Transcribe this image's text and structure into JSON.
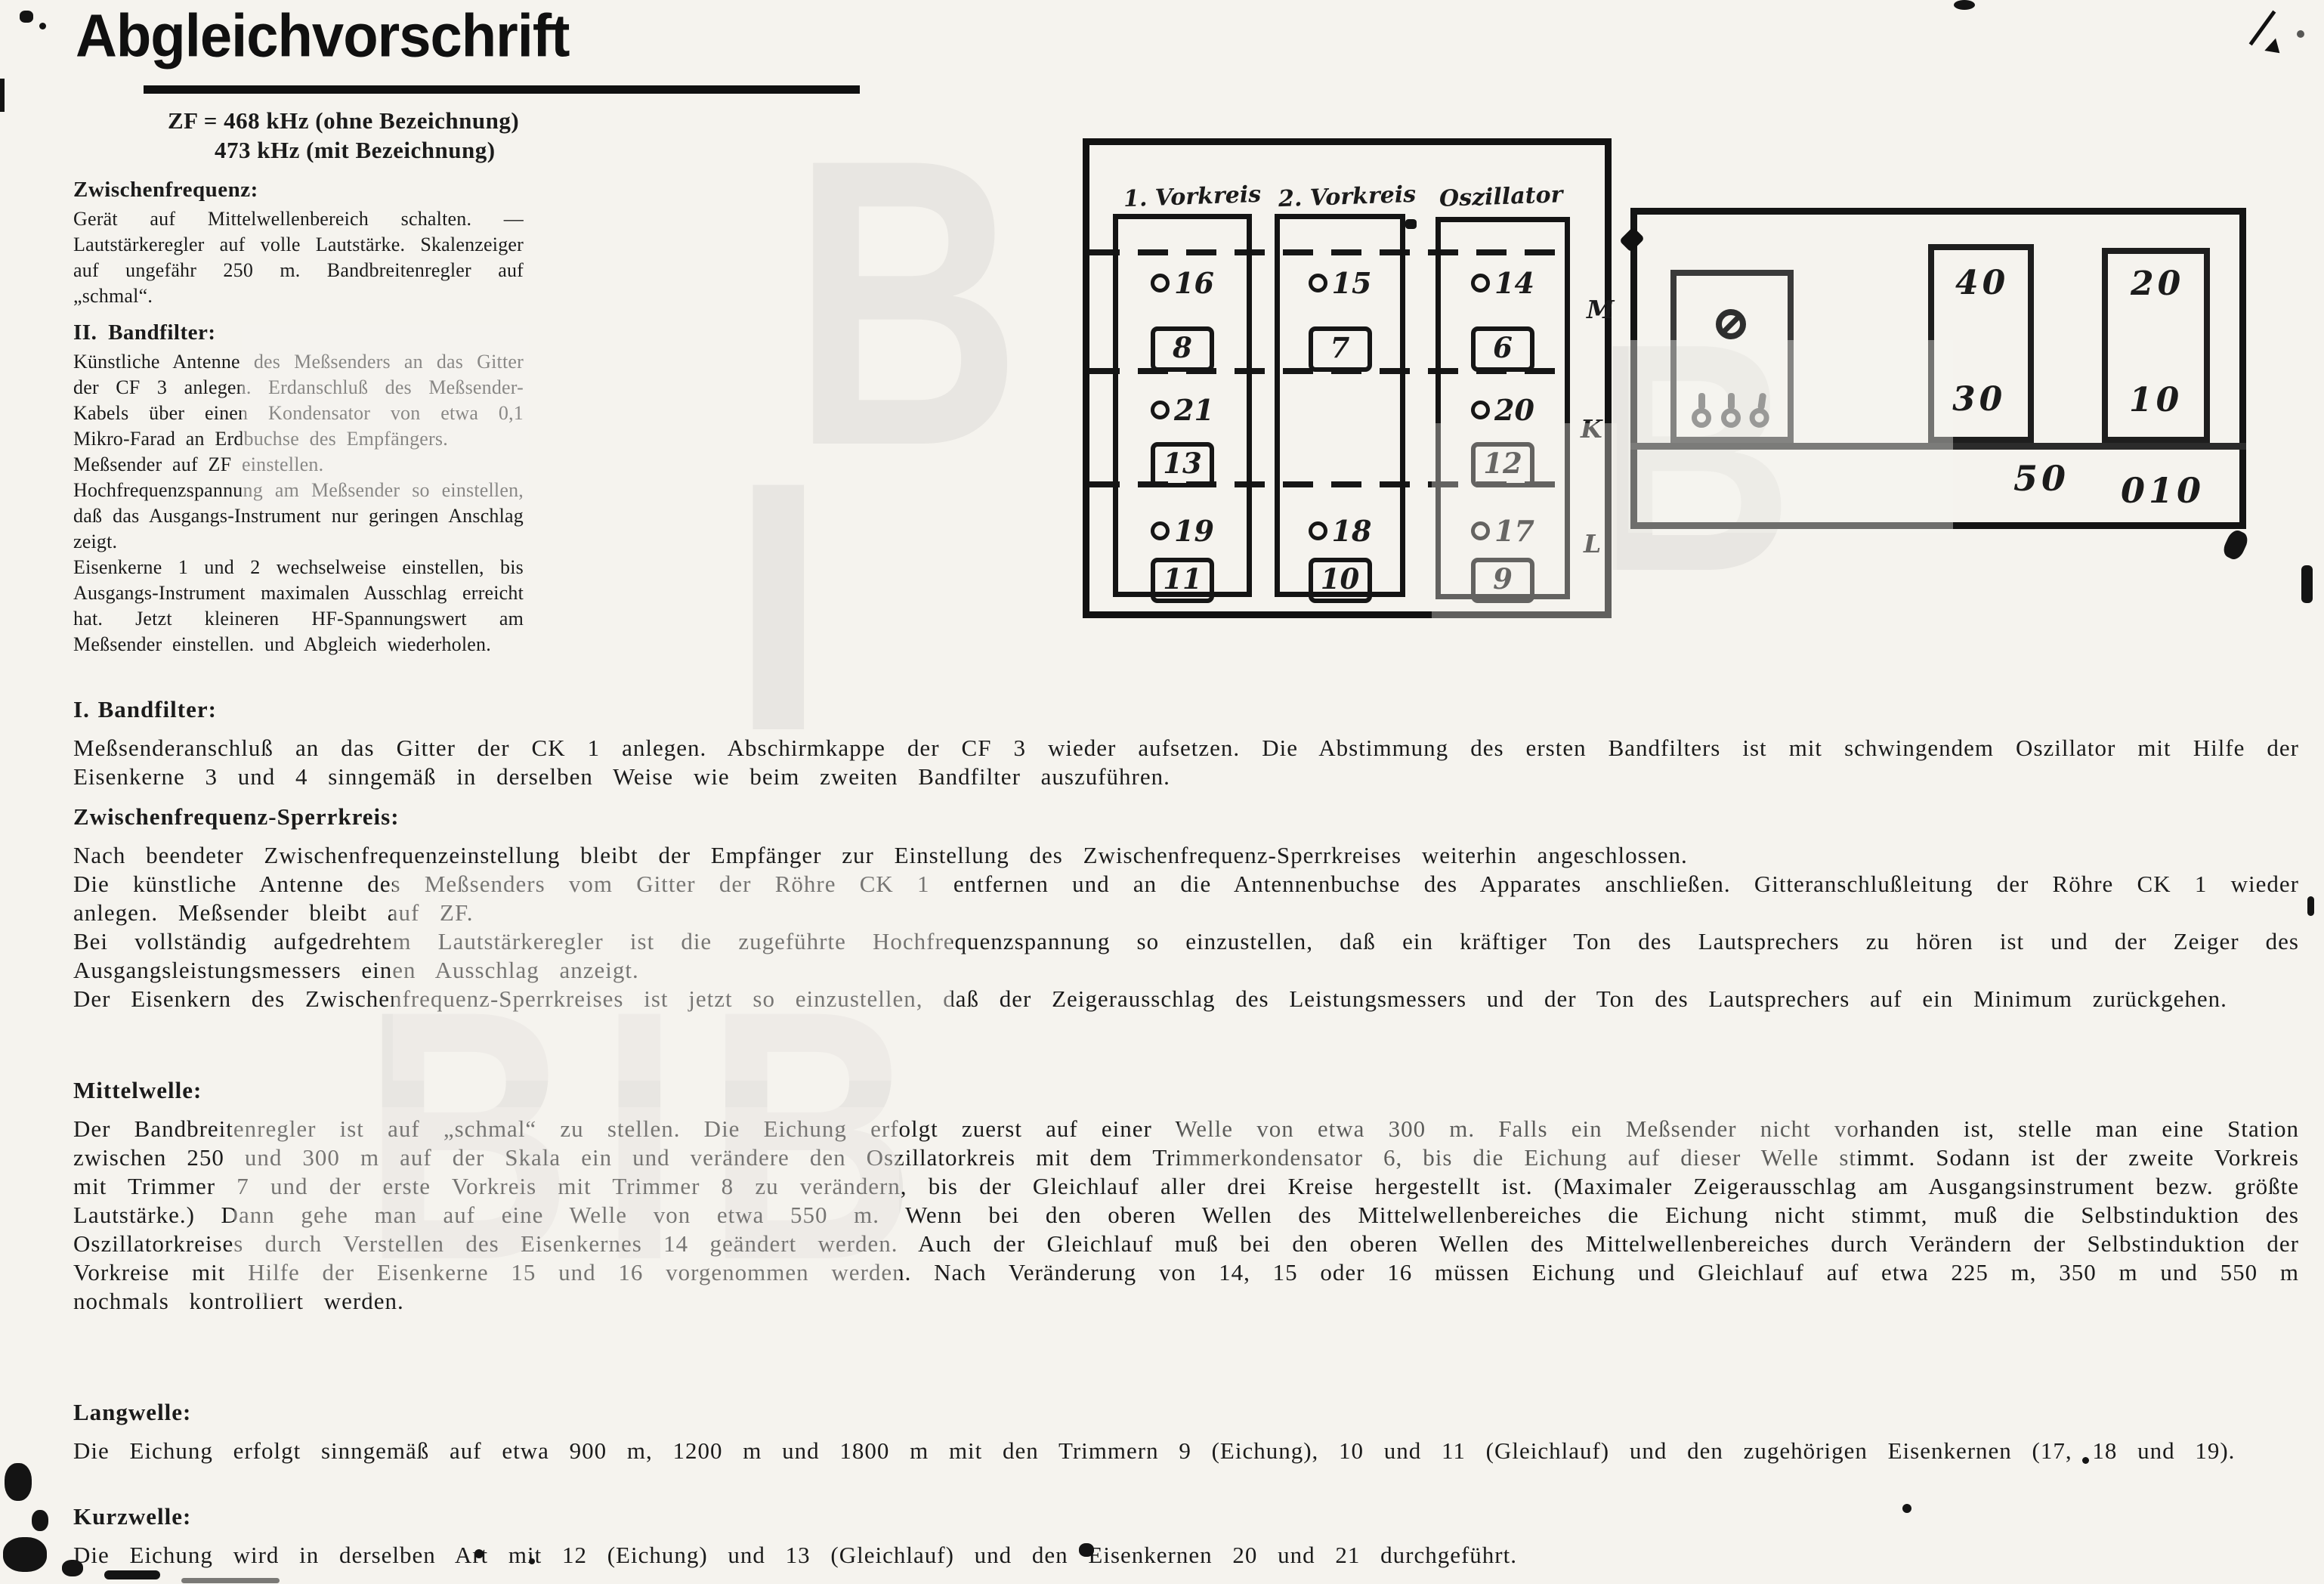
{
  "meta": {
    "paper_color": "#f5f3ee",
    "ink_color": "#1b1b1b",
    "language": "de"
  },
  "header": {
    "title": "Abgleichvorschrift",
    "zf_line1": "ZF = 468 kHz (ohne Bezeichnung)",
    "zf_line2": "473 kHz (mit Bezeichnung)"
  },
  "left_column": {
    "s1_heading": "Zwischenfrequenz:",
    "s1_p1": "Gerät auf Mittelwellenbereich schalten. — Lautstärkeregler auf volle Lautstärke. Skalenzeiger auf ungefähr 250 m. Bandbreitenregler auf „schmal“.",
    "s2_heading": "II. Bandfilter:",
    "s2_p1": "Künstliche Antenne des Meßsenders an das Gitter der CF 3 anlegen. Erdanschluß des Meßsender-Kabels über einen Kondensator von etwa 0,1 Mikro-Farad an Erdbuchse des Empfängers.",
    "s2_p2": "Meßsender auf ZF einstellen.",
    "s2_p3": "Hochfrequenzspannung am Meßsender so einstellen, daß das Ausgangs-Instrument nur geringen Anschlag zeigt.",
    "s2_p4": "Eisenkerne 1 und 2 wechselweise einstellen, bis Ausgangs-Instrument maximalen Ausschlag erreicht hat. Jetzt kleineren HF-Spannungswert am Meßsender einstellen. und Abgleich wiederholen."
  },
  "bandfilter1": {
    "heading": "I. Bandfilter:",
    "p1": "Meßsenderanschluß an das Gitter der CK 1 anlegen. Abschirmkappe der CF 3 wieder aufsetzen. Die Abstimmung des ersten Bandfilters ist mit schwingendem Oszillator mit Hilfe der Eisenkerne 3 und 4 sinngemäß in derselben Weise wie beim zweiten Bandfilter auszuführen."
  },
  "sperrkreis": {
    "heading": "Zwischenfrequenz-Sperrkreis:",
    "p1": "Nach beendeter Zwischenfrequenzeinstellung bleibt der Empfänger zur Einstellung des Zwischenfrequenz-Sperrkreises weiterhin angeschlossen.",
    "p2": "Die künstliche Antenne des Meßsenders vom Gitter der Röhre CK 1 entfernen und an die Antennenbuchse des Apparates anschließen. Gitteranschlußleitung der Röhre CK 1 wieder anlegen. Meßsender bleibt auf ZF.",
    "p3": "Bei vollständig aufgedrehtem Lautstärkeregler ist die zugeführte Hochfrequenzspannung so einzustellen, daß ein kräftiger Ton des Lautsprechers zu hören ist und der Zeiger des Ausgangsleistungsmessers einen Ausschlag anzeigt.",
    "p4": "Der Eisenkern des Zwischenfrequenz-Sperrkreises ist jetzt so einzustellen, daß der Zeigerausschlag des Leistungsmessers und der Ton des Lautsprechers auf ein Minimum zurückgehen."
  },
  "mittelwelle": {
    "heading": "Mittelwelle:",
    "p1": "Der Bandbreitenregler ist auf „schmal“ zu stellen. Die Eichung erfolgt zuerst auf einer Welle von etwa 300 m. Falls ein Meßsender nicht vorhanden ist, stelle man eine Station zwischen 250 und 300 m auf der Skala ein und verändere den Oszillatorkreis mit dem Trimmerkondensator 6, bis die Eichung auf dieser Welle stimmt. Sodann ist der zweite Vorkreis mit Trimmer 7 und der erste Vorkreis mit Trimmer 8 zu verändern, bis der Gleichlauf aller drei Kreise hergestellt ist. (Maximaler Zeigerausschlag am Ausgangsinstrument bezw. größte Lautstärke.) Dann gehe man auf eine Welle von etwa 550 m. Wenn bei den oberen Wellen des Mittelwellenbereiches die Eichung nicht stimmt, muß die Selbstinduktion des Oszillatorkreises durch Verstellen des Eisenkernes 14 geändert werden. Auch der Gleichlauf muß bei den oberen Wellen des Mittelwellenbereiches durch Verändern der Selbstinduktion der Vorkreise mit Hilfe der Eisenkerne 15 und 16 vorgenommen werden. Nach Veränderung von 14, 15 oder 16 müssen Eichung und Gleichlauf auf etwa 225 m, 350 m und 550 m nochmals kontrolliert werden."
  },
  "langwelle": {
    "heading": "Langwelle:",
    "p1": "Die Eichung erfolgt sinngemäß auf etwa 900 m, 1200 m und 1800 m mit den Trimmern 9 (Eichung), 10 und 11 (Gleichlauf) und den zugehörigen Eisenkernen (17, 18 und 19)."
  },
  "kurzwelle": {
    "heading": "Kurzwelle:",
    "p1": "Die Eichung wird in derselben Art mit 12 (Eichung) und 13 (Gleichlauf) und den Eisenkernen 20 und 21 durchgeführt."
  },
  "diagram1": {
    "col1_header": "1. Vorkreis",
    "col2_header": "2. Vorkreis",
    "col3_header": "Oszillator",
    "cores": {
      "c1r1": "16",
      "c1r2": "21",
      "c1r3": "19",
      "c2r1": "15",
      "c2r3": "18",
      "c3r1": "14",
      "c3r2": "20",
      "c3r3": "17"
    },
    "trimmers": {
      "c1r1": "8",
      "c1r2": "13",
      "c1r3": "11",
      "c2r1": "7",
      "c2r3": "10",
      "c3r1": "6",
      "c3r2": "12",
      "c3r3": "9"
    },
    "band_m": "M",
    "band_k": "K",
    "band_l": "L"
  },
  "diagram2": {
    "mid_top": "40",
    "mid_bottom": "30",
    "right_top": "20",
    "right_bottom": "10",
    "strip_left": "50",
    "strip_right": "010"
  },
  "icons": {
    "screw_head": "slotted-screw-icon",
    "solder_lug": "solder-lug-icon",
    "core_ring": "iron-core-ring-icon",
    "diamond_blob": "ink-blob-diamond"
  }
}
